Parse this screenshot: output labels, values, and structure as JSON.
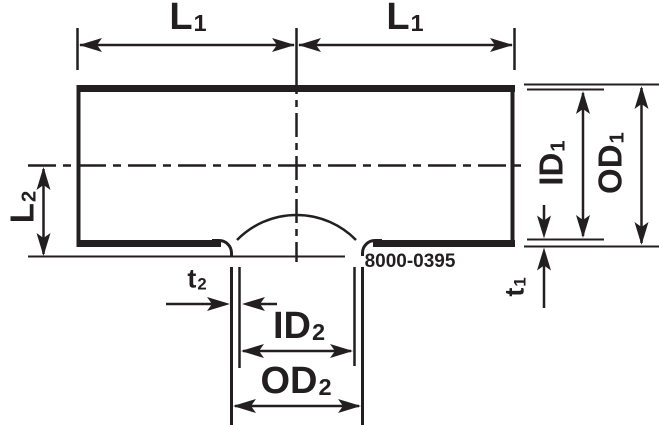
{
  "diagram": {
    "type": "technical-drawing-tee-fitting",
    "part_number": "8000-0395",
    "dimension_labels": {
      "l1_left": {
        "main": "L",
        "sub": "1"
      },
      "l1_right": {
        "main": "L",
        "sub": "1"
      },
      "l2": {
        "main": "L",
        "sub": "2"
      },
      "id1": {
        "main": "ID",
        "sub": "1"
      },
      "od1": {
        "main": "OD",
        "sub": "1"
      },
      "t1": {
        "main": "t",
        "sub": "1"
      },
      "t2": {
        "main": "t",
        "sub": "2"
      },
      "id2": {
        "main": "ID",
        "sub": "2"
      },
      "od2": {
        "main": "OD",
        "sub": "2"
      }
    },
    "colors": {
      "line": "#231f20",
      "background": "#ffffff"
    }
  }
}
